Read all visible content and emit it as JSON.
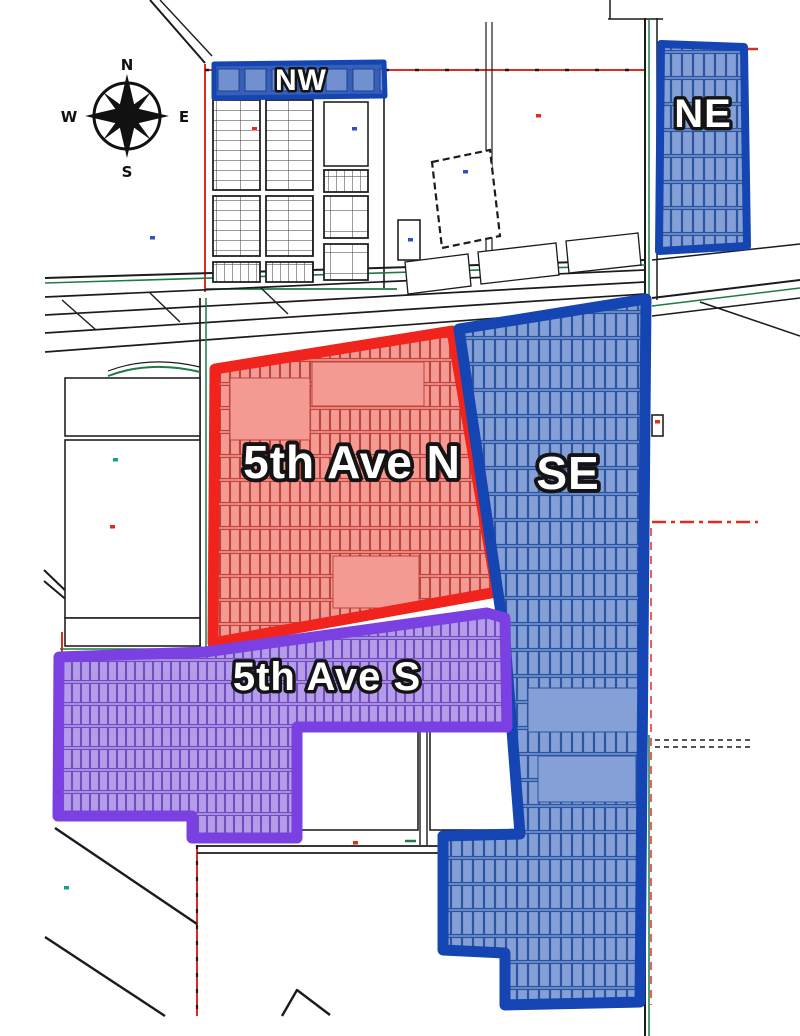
{
  "map": {
    "canvas": {
      "w": 800,
      "h": 1036,
      "bg": "#ffffff"
    },
    "compass": {
      "cx": 127,
      "cy": 116,
      "circle_r": 33,
      "n": "N",
      "e": "E",
      "s": "S",
      "w": "W"
    },
    "label_style": {
      "fill": "#ffffff",
      "stroke": "#141414"
    },
    "colors": {
      "black_line": "#1b1b1b",
      "green_line": "#1e7a46",
      "red_line": "#e02b20",
      "teal_mark": "#16a085",
      "blue_mark": "#2b53c0",
      "gray_lot_line": "#3a3a3a",
      "blue_border": "#1545b2",
      "blue_base": "#6488c8",
      "blue_lot_fill": "#84a0d6",
      "blue_lot_line": "#2d549e",
      "nw_base": "#2f5ab6",
      "nw_lot_fill": "#7090d0",
      "nw_lot_line": "#1e3f8f",
      "red_border": "#f0241d",
      "red_base": "#f2837c",
      "red_lot_fill": "#f49a93",
      "red_lot_line": "#b9463e",
      "purple_border": "#7b40e2",
      "purple_base": "#a78ae0",
      "purple_lot_fill": "#b59ce8",
      "purple_lot_line": "#6f4fc0"
    },
    "zones": [
      {
        "id": "fifth-ave-n",
        "label": "5th Ave N",
        "points": "215,369 452,331 497,592 213,643",
        "border": "#f0241d",
        "bw": 11,
        "base": "#f2837c",
        "pattern": "pred",
        "lx": 352,
        "ly": 478,
        "fs": 46,
        "plains": [
          [
            230,
            378,
            80,
            62
          ],
          [
            312,
            362,
            112,
            44
          ],
          [
            333,
            556,
            86,
            52
          ]
        ]
      },
      {
        "id": "se",
        "label": "SE",
        "points": "459,329 646,299 640,1002 505,1005 505,953 443,950 443,836 520,834 505,640",
        "border": "#1545b2",
        "bw": 11,
        "base": "#6488c8",
        "pattern": "pblue",
        "lx": 568,
        "ly": 489,
        "fs": 46,
        "plains": [
          [
            528,
            688,
            110,
            44
          ],
          [
            538,
            756,
            98,
            46
          ]
        ]
      },
      {
        "id": "fifth-ave-s",
        "label": "5th Ave S",
        "points": "59,657 205,652 487,613 505,618 507,727 297,727 297,838 192,838 192,816 58,816",
        "border": "#7b40e2",
        "bw": 11,
        "base": "#a78ae0",
        "pattern": "ppurple",
        "lx": 327,
        "ly": 690,
        "fs": 40,
        "plains": []
      },
      {
        "id": "nw",
        "label": "NW",
        "points": "214,64 384,62 385,96 214,98",
        "border": "#1545b2",
        "bw": 5,
        "base": "#2f5ab6",
        "pattern": "pnw",
        "lx": 301,
        "ly": 90,
        "fs": 30,
        "plains": []
      },
      {
        "id": "ne",
        "label": "NE",
        "points": "661,44 744,47 747,246 659,251",
        "border": "#1545b2",
        "bw": 8,
        "base": "#6488c8",
        "pattern": "pblue",
        "lx": 703,
        "ly": 127,
        "fs": 40,
        "plains": []
      }
    ],
    "base": {
      "lines": [
        [
          150,
          0,
          205,
          63,
          "k",
          2
        ],
        [
          160,
          0,
          212,
          56,
          "k",
          1.4
        ],
        [
          205,
          64,
          205,
          292,
          "r",
          2
        ],
        [
          205,
          70,
          645,
          70,
          "r",
          2
        ],
        [
          205,
          70,
          645,
          70,
          "k",
          2.4,
          "4 26"
        ],
        [
          741,
          49,
          758,
          49,
          "r",
          2.5
        ],
        [
          384,
          96,
          384,
          288,
          "k",
          1.6
        ],
        [
          205,
          289,
          397,
          289,
          "g",
          1.8
        ],
        [
          486,
          22,
          486,
          252,
          "k",
          1.2
        ],
        [
          492,
          22,
          492,
          252,
          "k",
          1.2
        ],
        [
          610,
          0,
          610,
          19,
          "k",
          1.5
        ],
        [
          608,
          19,
          663,
          19,
          "k",
          1.5
        ],
        [
          645,
          18,
          645,
          1036,
          "k",
          2
        ],
        [
          657,
          18,
          657,
          300,
          "k",
          1.5
        ],
        [
          649,
          20,
          649,
          300,
          "g",
          1.5
        ],
        [
          649,
          735,
          649,
          1036,
          "g",
          1.5
        ],
        [
          652,
          522,
          758,
          522,
          "r",
          2.5,
          "14 5 4 5"
        ],
        [
          651,
          528,
          651,
          1005,
          "r",
          1.5,
          "8 6"
        ],
        [
          655,
          740,
          753,
          740,
          "k",
          1.4,
          "5 4"
        ],
        [
          655,
          747,
          753,
          747,
          "k",
          1.4,
          "5 4"
        ],
        [
          45,
          278,
          645,
          260,
          "k",
          2
        ],
        [
          45,
          283,
          645,
          265,
          "g",
          1.6
        ],
        [
          45,
          297,
          645,
          270,
          "k",
          1.7
        ],
        [
          45,
          315,
          645,
          282,
          "k",
          1.7
        ],
        [
          45,
          333,
          645,
          294,
          "k",
          1.7
        ],
        [
          45,
          352,
          645,
          307,
          "k",
          1.7
        ],
        [
          62,
          300,
          96,
          330,
          "k",
          1.4
        ],
        [
          150,
          293,
          180,
          322,
          "k",
          1.4
        ],
        [
          260,
          287,
          288,
          314,
          "k",
          1.4
        ],
        [
          652,
          298,
          800,
          280,
          "k",
          2
        ],
        [
          652,
          306,
          800,
          288,
          "g",
          1.5
        ],
        [
          652,
          316,
          800,
          298,
          "k",
          1.5
        ],
        [
          652,
          260,
          800,
          244,
          "k",
          1.5
        ],
        [
          700,
          302,
          800,
          336,
          "k",
          1.5
        ],
        [
          200,
          298,
          200,
          654,
          "k",
          1.7
        ],
        [
          206,
          298,
          206,
          654,
          "g",
          1.5
        ],
        [
          62,
          632,
          62,
          660,
          "r",
          2
        ],
        [
          60,
          649,
          206,
          649,
          "g",
          1.5
        ],
        [
          44,
          570,
          98,
          622,
          "k",
          2
        ],
        [
          44,
          581,
          106,
          633,
          "k",
          2
        ],
        [
          197,
          845,
          197,
          1016,
          "r",
          2
        ],
        [
          197,
          845,
          197,
          1016,
          "k",
          2.2,
          "4 12"
        ],
        [
          197,
          846,
          445,
          846,
          "k",
          1.7
        ],
        [
          197,
          853,
          445,
          853,
          "k",
          1.7
        ],
        [
          55,
          828,
          197,
          924,
          "k",
          2.4
        ],
        [
          45,
          937,
          165,
          1016,
          "k",
          2.4
        ],
        [
          297,
          727,
          520,
          727,
          "k",
          1.4
        ],
        [
          297,
          731,
          520,
          731,
          "g",
          1.8
        ],
        [
          420,
          731,
          420,
          845,
          "k",
          1.4
        ],
        [
          427,
          731,
          427,
          845,
          "k",
          1.4
        ],
        [
          470,
          345,
          512,
          638,
          "g",
          2,
          "8 9"
        ],
        [
          405,
          841,
          416,
          841,
          "g",
          2.5
        ],
        [
          112,
          378,
          112,
          436,
          "k",
          1.4
        ],
        [
          152,
          378,
          152,
          436,
          "k",
          1.4
        ],
        [
          152,
          440,
          152,
          618,
          "k",
          1.6
        ],
        [
          152,
          530,
          200,
          530,
          "k",
          1.6
        ],
        [
          100,
          618,
          100,
          646,
          "k",
          1.4
        ],
        [
          140,
          618,
          140,
          646,
          "k",
          1.4
        ]
      ],
      "paths": [
        {
          "d": "M282,1016 L297,990 L330,1015",
          "c": "k",
          "w": 2.4
        },
        {
          "d": "M108,376 Q150,360 200,372",
          "c": "g",
          "w": 2
        },
        {
          "d": "M108,371 Q150,355 200,367",
          "c": "k",
          "w": 1.2
        },
        {
          "d": "M455,762 L472,755 L480,770 L470,786 L455,780 Z",
          "c": "k",
          "w": 1.2
        }
      ],
      "rects": [
        [
          65,
          378,
          135,
          58
        ],
        [
          65,
          440,
          135,
          178
        ],
        [
          65,
          618,
          135,
          28
        ],
        [
          398,
          220,
          22,
          40
        ],
        [
          300,
          731,
          118,
          99
        ],
        [
          430,
          731,
          88,
          99
        ],
        [
          324,
          102,
          44,
          64
        ],
        [
          652,
          415,
          11,
          21
        ]
      ],
      "quads": [
        {
          "pts": "432,162 490,150 500,236 442,248",
          "w": 2.2,
          "dash": "7 4"
        },
        {
          "pts": "405,262 468,254 471,286 408,294",
          "w": 1.3
        },
        {
          "pts": "478,252 556,243 559,275 481,284",
          "w": 1.3
        },
        {
          "pts": "566,241 638,233 641,265 569,273",
          "w": 1.3
        }
      ],
      "blocks": [
        [
          213,
          100,
          47,
          90,
          "pg"
        ],
        [
          266,
          100,
          47,
          90,
          "pg"
        ],
        [
          324,
          170,
          44,
          22,
          "pv"
        ],
        [
          213,
          196,
          47,
          60,
          "pg"
        ],
        [
          266,
          196,
          47,
          60,
          "pg"
        ],
        [
          324,
          196,
          44,
          42,
          "ps"
        ],
        [
          213,
          262,
          47,
          20,
          "pv"
        ],
        [
          266,
          262,
          47,
          20,
          "pv"
        ],
        [
          324,
          244,
          44,
          36,
          "ps"
        ]
      ],
      "marks": [
        {
          "x": 150,
          "y": 236,
          "c": "b"
        },
        {
          "x": 252,
          "y": 127,
          "c": "r"
        },
        {
          "x": 352,
          "y": 127,
          "c": "b"
        },
        {
          "x": 463,
          "y": 170,
          "c": "b"
        },
        {
          "x": 408,
          "y": 238,
          "c": "b"
        },
        {
          "x": 722,
          "y": 132,
          "c": "r"
        },
        {
          "x": 110,
          "y": 525,
          "c": "r"
        },
        {
          "x": 113,
          "y": 458,
          "c": "t"
        },
        {
          "x": 353,
          "y": 841,
          "c": "r"
        },
        {
          "x": 64,
          "y": 886,
          "c": "t"
        },
        {
          "x": 655,
          "y": 420,
          "c": "r"
        },
        {
          "x": 536,
          "y": 114,
          "c": "r"
        }
      ]
    }
  }
}
